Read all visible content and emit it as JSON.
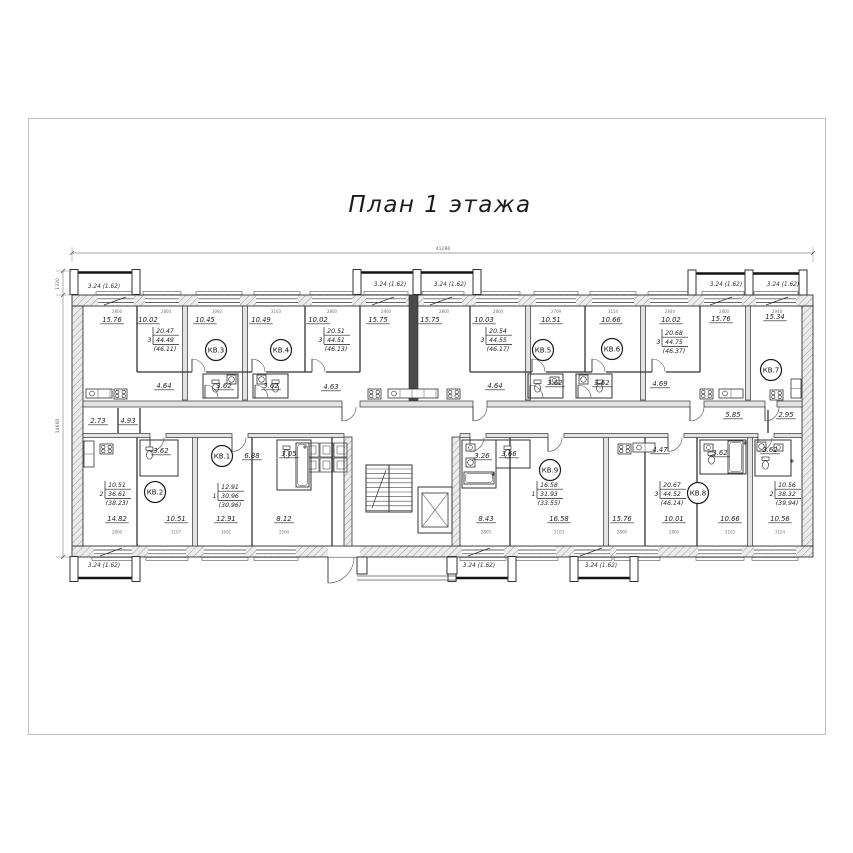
{
  "title": "План 1 этажа",
  "colors": {
    "line": "#333333",
    "dark": "#1b1b1b",
    "wall_fill": "#ececec",
    "frame": "#bfbfbf",
    "dim": "#777777"
  },
  "balcony_label": "3.24 (1.62)",
  "balcony_label_positions": [
    {
      "x": 104,
      "y": 288
    },
    {
      "x": 390,
      "y": 286
    },
    {
      "x": 450,
      "y": 286
    },
    {
      "x": 726,
      "y": 286
    },
    {
      "x": 783,
      "y": 286
    },
    {
      "x": 104,
      "y": 567
    },
    {
      "x": 479,
      "y": 567
    },
    {
      "x": 601,
      "y": 567
    }
  ],
  "apartments": [
    {
      "num": "КВ.1",
      "rooms": "1",
      "living": "12.91",
      "total": "30.96",
      "with_balcony": "(30.96)",
      "cx": 222,
      "cy": 456,
      "tx": 227,
      "ty": 489
    },
    {
      "num": "КВ.2",
      "rooms": "2",
      "living": "10.51",
      "total": "36.61",
      "with_balcony": "(38.23)",
      "cx": 155,
      "cy": 492,
      "tx": 114,
      "ty": 487
    },
    {
      "num": "КВ.3",
      "rooms": "3",
      "living": "20.47",
      "total": "44.49",
      "with_balcony": "(46.11)",
      "cx": 216,
      "cy": 350,
      "tx": 162,
      "ty": 333
    },
    {
      "num": "КВ.4",
      "rooms": "3",
      "living": "20.51",
      "total": "44.51",
      "with_balcony": "(46.13)",
      "cx": 281,
      "cy": 350,
      "tx": 333,
      "ty": 333
    },
    {
      "num": "КВ.5",
      "rooms": "3",
      "living": "20.54",
      "total": "44.55",
      "with_balcony": "(46.17)",
      "cx": 543,
      "cy": 350,
      "tx": 495,
      "ty": 333
    },
    {
      "num": "КВ.6",
      "rooms": "3",
      "living": "20.68",
      "total": "44.75",
      "with_balcony": "(46.37)",
      "cx": 612,
      "cy": 349,
      "tx": 671,
      "ty": 335
    },
    {
      "num": "КВ.7",
      "rooms": "2",
      "living": "10.56",
      "total": "38.32",
      "with_balcony": "(39.94)",
      "cx": 771,
      "cy": 370,
      "tx": 784,
      "ty": 487
    },
    {
      "num": "КВ.8",
      "rooms": "3",
      "living": "20.67",
      "total": "44.52",
      "with_balcony": "(46.14)",
      "cx": 698,
      "cy": 493,
      "tx": 669,
      "ty": 487
    },
    {
      "num": "КВ.9",
      "rooms": "1",
      "living": "16.58",
      "total": "31.93",
      "with_balcony": "(33.55)",
      "cx": 550,
      "cy": 470,
      "tx": 546,
      "ty": 487
    }
  ],
  "room_areas": [
    {
      "x": 112,
      "y": 322,
      "t": "15.76"
    },
    {
      "x": 148,
      "y": 322,
      "t": "10.02"
    },
    {
      "x": 205,
      "y": 322,
      "t": "10.45"
    },
    {
      "x": 261,
      "y": 322,
      "t": "10.49"
    },
    {
      "x": 318,
      "y": 322,
      "t": "10.02"
    },
    {
      "x": 378,
      "y": 322,
      "t": "15.75"
    },
    {
      "x": 430,
      "y": 322,
      "t": "15.75"
    },
    {
      "x": 484,
      "y": 322,
      "t": "10.03"
    },
    {
      "x": 551,
      "y": 322,
      "t": "10.51"
    },
    {
      "x": 611,
      "y": 322,
      "t": "10.66"
    },
    {
      "x": 671,
      "y": 322,
      "t": "10.02"
    },
    {
      "x": 721,
      "y": 321,
      "t": "15.76"
    },
    {
      "x": 775,
      "y": 319,
      "t": "15.34"
    },
    {
      "x": 164,
      "y": 388,
      "t": "4.64"
    },
    {
      "x": 224,
      "y": 388,
      "t": "3.62"
    },
    {
      "x": 271,
      "y": 388,
      "t": "3.62"
    },
    {
      "x": 331,
      "y": 389,
      "t": "4.63"
    },
    {
      "x": 495,
      "y": 388,
      "t": "4.64"
    },
    {
      "x": 555,
      "y": 385,
      "t": "3.62"
    },
    {
      "x": 602,
      "y": 385,
      "t": "3.62"
    },
    {
      "x": 660,
      "y": 386,
      "t": "4.69"
    },
    {
      "x": 98,
      "y": 423,
      "t": "2.73"
    },
    {
      "x": 128,
      "y": 423,
      "t": "4.93"
    },
    {
      "x": 733,
      "y": 417,
      "t": "5.85"
    },
    {
      "x": 786,
      "y": 417,
      "t": "2.95"
    },
    {
      "x": 161,
      "y": 453,
      "t": "3.62"
    },
    {
      "x": 252,
      "y": 458,
      "t": "6.88"
    },
    {
      "x": 289,
      "y": 456,
      "t": "3.05"
    },
    {
      "x": 482,
      "y": 458,
      "t": "3.26"
    },
    {
      "x": 509,
      "y": 456,
      "t": "3.66"
    },
    {
      "x": 660,
      "y": 452,
      "t": "4.47"
    },
    {
      "x": 720,
      "y": 455,
      "t": "3.62"
    },
    {
      "x": 770,
      "y": 452,
      "t": "3.62"
    },
    {
      "x": 117,
      "y": 521,
      "t": "14.82"
    },
    {
      "x": 176,
      "y": 521,
      "t": "10.51"
    },
    {
      "x": 226,
      "y": 521,
      "t": "12.91"
    },
    {
      "x": 284,
      "y": 521,
      "t": "8.12"
    },
    {
      "x": 486,
      "y": 521,
      "t": "8.43"
    },
    {
      "x": 559,
      "y": 521,
      "t": "16.58"
    },
    {
      "x": 622,
      "y": 521,
      "t": "15.76"
    },
    {
      "x": 674,
      "y": 521,
      "t": "10.01"
    },
    {
      "x": 730,
      "y": 521,
      "t": "10.66"
    },
    {
      "x": 780,
      "y": 521,
      "t": "10.56"
    }
  ],
  "dimensions": {
    "top_total": "41286",
    "left_total": "14660",
    "left_balcony": "1330",
    "top_segments": [
      {
        "x": 117,
        "t": "2800"
      },
      {
        "x": 166,
        "t": "2800"
      },
      {
        "x": 217,
        "t": "3092"
      },
      {
        "x": 276,
        "t": "3103"
      },
      {
        "x": 332,
        "t": "2800"
      },
      {
        "x": 386,
        "t": "2900"
      },
      {
        "x": 444,
        "t": "2800"
      },
      {
        "x": 498,
        "t": "2800"
      },
      {
        "x": 556,
        "t": "2709"
      },
      {
        "x": 613,
        "t": "3154"
      },
      {
        "x": 670,
        "t": "2840"
      },
      {
        "x": 724,
        "t": "2800"
      },
      {
        "x": 777,
        "t": "2948"
      }
    ],
    "bottom_segments": [
      {
        "x": 117,
        "t": "2800"
      },
      {
        "x": 176,
        "t": "3107"
      },
      {
        "x": 226,
        "t": "3601"
      },
      {
        "x": 284,
        "t": "2504"
      },
      {
        "x": 486,
        "t": "2805"
      },
      {
        "x": 559,
        "t": "3103"
      },
      {
        "x": 622,
        "t": "2800"
      },
      {
        "x": 674,
        "t": "2800"
      },
      {
        "x": 730,
        "t": "3103"
      },
      {
        "x": 780,
        "t": "3124"
      }
    ]
  }
}
